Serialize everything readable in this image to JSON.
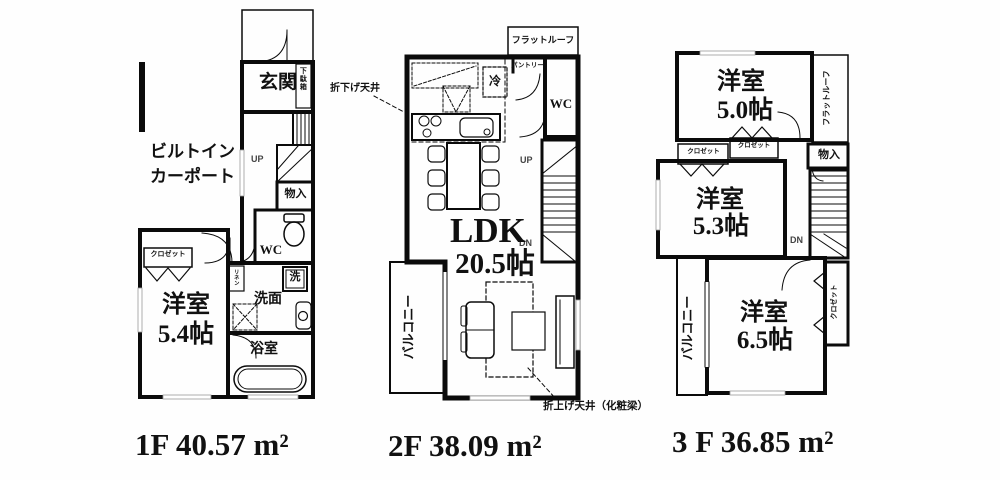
{
  "floor1": {
    "entrance": "玄関",
    "shoe_cabinet": "下駄箱",
    "carport_line1": "ビルトイン",
    "carport_line2": "カーポート",
    "up": "UP",
    "storage": "物入",
    "wc": "WC",
    "closet": "クロゼット",
    "linen": "リネン",
    "room_name": "洋室",
    "room_size": "5.4帖",
    "laundry": "洗",
    "washroom": "洗面",
    "bathroom": "浴室",
    "area_label": "1F 40.57 m²"
  },
  "floor2": {
    "flat_roof": "フラットルーフ",
    "pantry": "パントリー",
    "fridge": "冷",
    "wc": "WC",
    "up": "UP",
    "dn": "DN",
    "ldk_name": "LDK",
    "ldk_size": "20.5帖",
    "balcony": "バルコニー",
    "lowered_ceiling_note": "折下げ天井",
    "raised_ceiling_note": "折上げ天井（化粧梁）",
    "area_label": "2F 38.09 m²"
  },
  "floor3": {
    "room1_name": "洋室",
    "room1_size": "5.0帖",
    "flat_roof": "フラットルーフ",
    "closet_left": "クロゼット",
    "closet_mid": "クロゼット",
    "storage": "物入",
    "room2_name": "洋室",
    "room2_size": "5.3帖",
    "dn": "DN",
    "room3_name": "洋室",
    "room3_size": "6.5帖",
    "balcony": "バルコニー",
    "closet_right": "クロゼット",
    "area_label": "3 F 36.85 m²"
  }
}
